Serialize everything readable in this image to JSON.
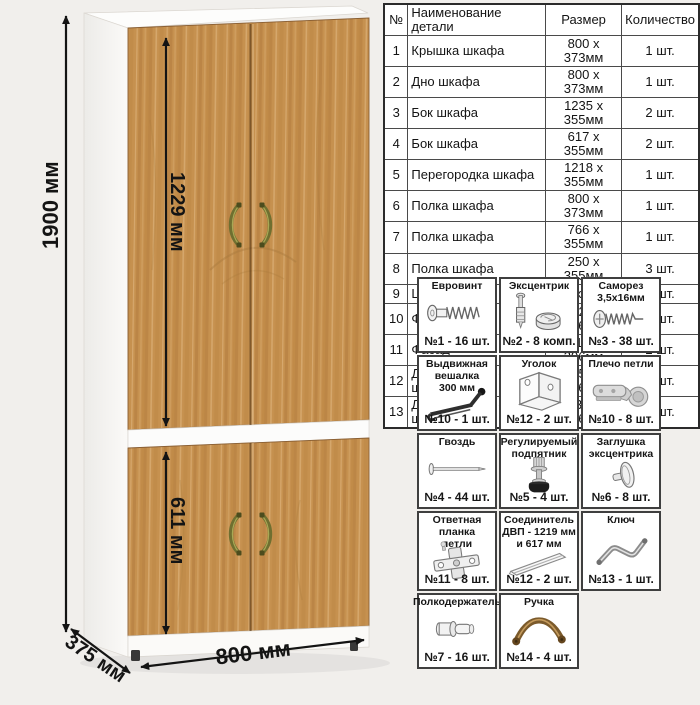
{
  "diagram": {
    "height_label": "1900 мм",
    "upper_door_label": "1229 мм",
    "lower_door_label": "611 мм",
    "width_label": "800 мм",
    "depth_label": "375 мм",
    "wood_color": "#c6914f",
    "handle_color": "#6f6f30"
  },
  "parts_table": {
    "headers": [
      "№",
      "Наименование детали",
      "Размер",
      "Количество"
    ],
    "rows": [
      {
        "num": "1",
        "name": "Крышка шкафа",
        "size": "800 x 373мм",
        "qty": "1 шт."
      },
      {
        "num": "2",
        "name": "Дно шкафа",
        "size": "800 x 373мм",
        "qty": "1 шт."
      },
      {
        "num": "3",
        "name": "Бок шкафа",
        "size": "1235 x 355мм",
        "qty": "2 шт."
      },
      {
        "num": "4",
        "name": "Бок шкафа",
        "size": "617 x 355мм",
        "qty": "2 шт."
      },
      {
        "num": "5",
        "name": "Перегородка шкафа",
        "size": "1218 x 355мм",
        "qty": "1 шт."
      },
      {
        "num": "6",
        "name": "Полка шкафа",
        "size": "800 x 373мм",
        "qty": "1 шт."
      },
      {
        "num": "7",
        "name": "Полка шкафа",
        "size": "766 x 355мм",
        "qty": "1 шт."
      },
      {
        "num": "8",
        "name": "Полка шкафа",
        "size": "250 x 355мм",
        "qty": "3 шт."
      },
      {
        "num": "9",
        "name": "Царга шкафа",
        "size": "768 x 70мм",
        "qty": "2 шт."
      },
      {
        "num": "10",
        "name": "Фасад",
        "size": "1229 x 396мм",
        "qty": "2 шт."
      },
      {
        "num": "11",
        "name": "Фасад",
        "size": "611 x 396мм",
        "qty": "2 шт."
      },
      {
        "num": "12",
        "name": "ДВП – задняя стенка шкафа",
        "size": "1257 x 396мм",
        "qty": "2 шт."
      },
      {
        "num": "13",
        "name": "ДВП – задняя стенка шкафа",
        "size": "639 x 396мм",
        "qty": "2 шт."
      }
    ]
  },
  "hardware": {
    "items": [
      {
        "title": "Евровинт",
        "count": "№1 - 16 шт.",
        "icon": "euroscrew-icon"
      },
      {
        "title": "Эксцентрик",
        "count": "№2 - 8 комп.",
        "icon": "eccentric-cam-icon"
      },
      {
        "title": "Саморез\n3,5х16мм",
        "count": "№3 - 38 шт.",
        "icon": "self-tapping-screw-icon"
      },
      {
        "title": "Выдвижная\nвешалка\n300 мм",
        "count": "№10 - 1 шт.",
        "icon": "pullout-hanger-icon"
      },
      {
        "title": "Уголок",
        "count": "№12 - 2 шт.",
        "icon": "corner-bracket-icon"
      },
      {
        "title": "Плечо петли",
        "count": "№10 - 8 шт.",
        "icon": "hinge-arm-icon"
      },
      {
        "title": "Гвоздь",
        "count": "№4 - 44 шт.",
        "icon": "nail-icon"
      },
      {
        "title": "Регулируемый\nподпятник",
        "count": "№5 - 4 шт.",
        "icon": "adjustable-foot-icon"
      },
      {
        "title": "Заглушка\nэксцентрика",
        "count": "№6 - 8 шт.",
        "icon": "cam-cover-icon"
      },
      {
        "title": "Ответная планка\nпетли",
        "count": "№11 - 8 шт.",
        "icon": "hinge-plate-icon"
      },
      {
        "title": "Соединитель\nДВП - 1219 мм\nи 617 мм",
        "count": "№12 - 2 шт.",
        "icon": "hdf-connector-icon"
      },
      {
        "title": "Ключ",
        "count": "№13 - 1 шт.",
        "icon": "hex-key-icon"
      },
      {
        "title": "Полкодержатель",
        "count": "№7 - 16 шт.",
        "icon": "shelf-pin-icon"
      },
      {
        "title": "Ручка",
        "count": "№14 - 4 шт.",
        "icon": "handle-icon"
      }
    ]
  }
}
